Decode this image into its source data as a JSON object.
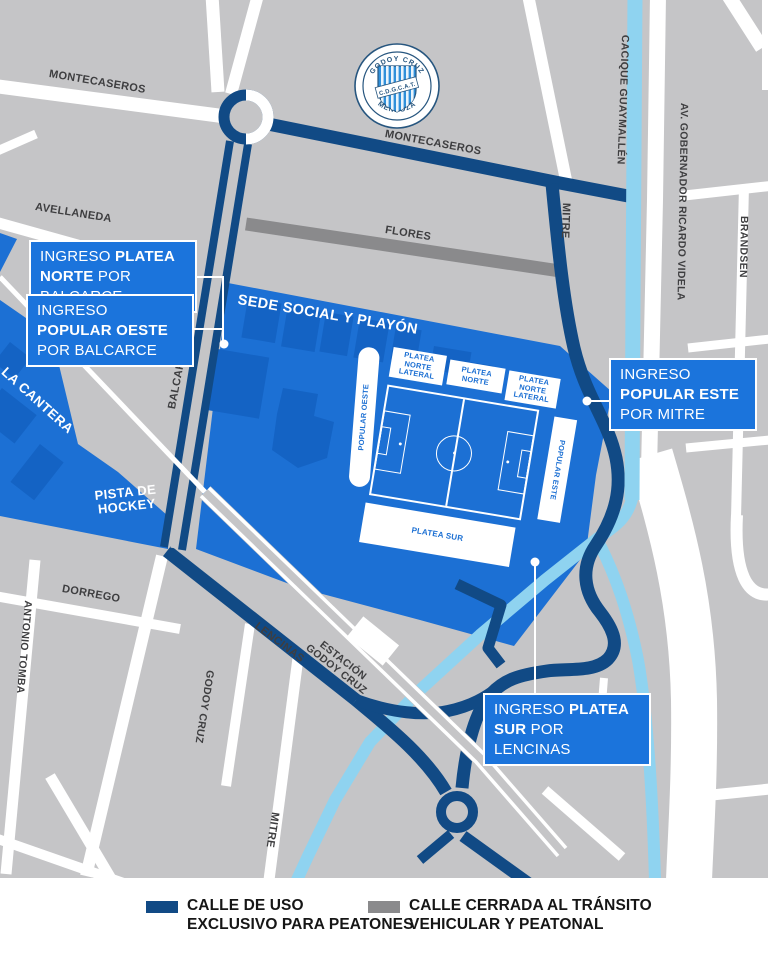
{
  "colors": {
    "map_background": "#c5c5c7",
    "pedestrian_street_navy": "#114a85",
    "closed_street_gray": "#8a8a8c",
    "club_area_blue": "#1c70d4",
    "building_blue": "#1463c4",
    "canal_cyan": "#8fd3f0",
    "callout_blue": "#1b74dc",
    "street_label_gray": "#3e3e40"
  },
  "logo": {
    "top_text": "GODOY CRUZ",
    "band_text": "C.D.G.C.A.T.",
    "bottom_text": "MENDOZA"
  },
  "streets": {
    "montecaseros_nw": "MONTECASEROS",
    "montecaseros_ne": "MONTECASEROS",
    "avellaneda": "AVELLANEDA",
    "flores": "FLORES",
    "mitre_ne": "MITRE",
    "cacique_guaymallen": "CACIQUE GUAYMALLÉN",
    "gobernador_videla": "AV. GOBERNADOR RICARDO VIDELA",
    "brandsen": "BRANDSEN",
    "balcarce": "BALCARCE",
    "dorrego": "DORREGO",
    "antonio_tomba": "ANTONIO TOMBA",
    "godoy_cruz": "GODOY CRUZ",
    "lencinas": "LENCINAS",
    "mitre_s": "MITRE",
    "estacion_line1": "ESTACIÓN",
    "estacion_line2": "GODOY CRUZ"
  },
  "areas": {
    "la_cantera": "LA CANTERA",
    "pista_line1": "PISTA DE",
    "pista_line2": "HOCKEY",
    "sede_social": "SEDE SOCIAL Y PLAYÓN"
  },
  "stadium": {
    "popular_oeste": "POPULAR OESTE",
    "popular_este": "POPULAR ESTE",
    "platea_sur": "PLATEA SUR",
    "platea_norte": "PLATEA NORTE",
    "platea_norte_lateral_izq": "PLATEA NORTE LATERAL",
    "platea_norte_lateral_der": "PLATEA NORTE LATERAL"
  },
  "callouts": {
    "platea_norte": {
      "segments": [
        {
          "t": "INGRESO ",
          "b": false
        },
        {
          "t": "PLATEA NORTE",
          "b": true
        },
        {
          "t": " POR BALCARCE",
          "b": false
        }
      ]
    },
    "popular_oeste": {
      "segments": [
        {
          "t": "INGRESO ",
          "b": false
        },
        {
          "t": "POPULAR OESTE",
          "b": true
        },
        {
          "t": " POR BALCARCE",
          "b": false
        }
      ]
    },
    "popular_este": {
      "segments": [
        {
          "t": "INGRESO ",
          "b": false
        },
        {
          "t": "POPULAR ESTE",
          "b": true
        },
        {
          "t": " POR MITRE",
          "b": false
        }
      ]
    },
    "platea_sur": {
      "segments": [
        {
          "t": "INGRESO ",
          "b": false
        },
        {
          "t": "PLATEA SUR",
          "b": true
        },
        {
          "t": " POR LENCINAS",
          "b": false
        }
      ]
    }
  },
  "legend": {
    "items": [
      {
        "swatch_color": "#114a85",
        "line1": "CALLE DE USO",
        "line2": "EXCLUSIVO PARA PEATONES"
      },
      {
        "swatch_color": "#8a8a8c",
        "line1": "CALLE CERRADA AL TRÁNSITO",
        "line2": "VEHICULAR Y PEATONAL"
      }
    ]
  }
}
